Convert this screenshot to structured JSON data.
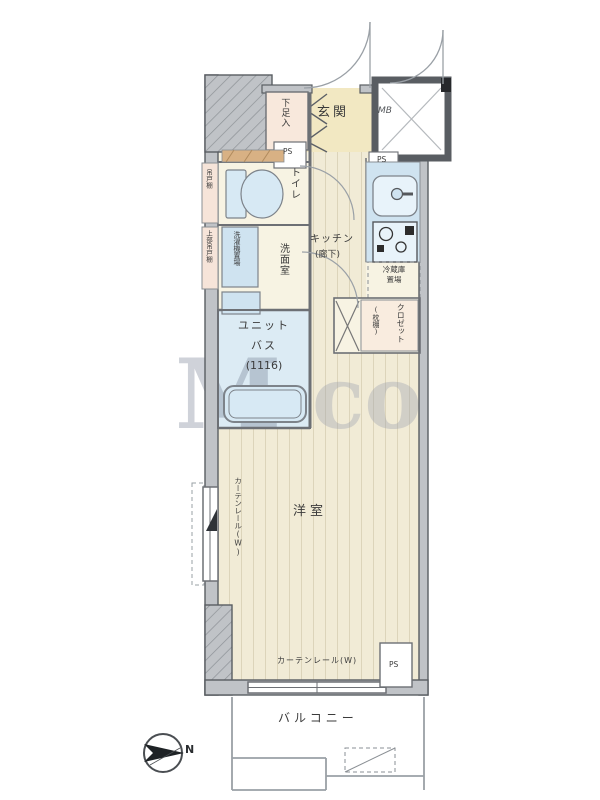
{
  "labels": {
    "genkan": "玄関",
    "shoe_box": "下足入",
    "ps_entrance": "PS",
    "mb": "MB",
    "toilet": "トイレ",
    "cabinet_toilet": "吊戸棚",
    "cabinet_washer": "上部吊戸棚",
    "washer": "洗濯機置場",
    "washroom": "洗面室",
    "kitchen": "キッチン",
    "kitchen_sub": "(廊下)",
    "ps_kitchen": "PS",
    "fridge_line1": "冷蔵庫",
    "fridge_line2": "置場",
    "closet": "クロゼット",
    "closet_sub": "(枕棚)",
    "unit_bath_line1": "ユニット",
    "unit_bath_line2": "バス",
    "unit_bath_line3": "(1116)",
    "western_room": "洋室",
    "curtain_rail_left": "カーテンレール(W)",
    "curtain_rail_bottom": "カーテンレール(W)",
    "ps_room": "PS",
    "balcony": "バルコニー",
    "compass_north": "N"
  },
  "watermark": {
    "left": "M",
    "right": "co"
  },
  "colors": {
    "wall_fill": "#c0c3c7",
    "wall_edge": "#595d62",
    "floor_cream": "#f1ebd6",
    "floor_line": "#dcd4ba",
    "water_blue": "#cfe3f0",
    "bath_blue": "#dcebf4",
    "storage_pink": "#f8e8dc",
    "shelf_tan": "#d8b184"
  }
}
